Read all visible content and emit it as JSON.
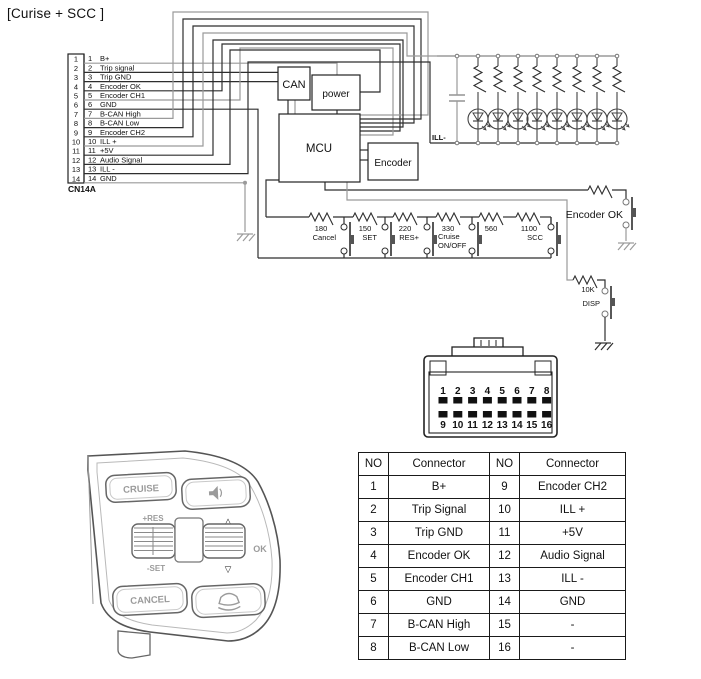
{
  "title": "[Curise + SCC ]",
  "connector_block": {
    "label": "CN14A",
    "pins": [
      {
        "no": "1",
        "label": "B+"
      },
      {
        "no": "2",
        "label": "Trip signal"
      },
      {
        "no": "3",
        "label": "Trip GND"
      },
      {
        "no": "4",
        "label": "Encoder OK"
      },
      {
        "no": "5",
        "label": "Encoder CH1"
      },
      {
        "no": "6",
        "label": "GND"
      },
      {
        "no": "7",
        "label": "B-CAN High"
      },
      {
        "no": "8",
        "label": "B-CAN Low"
      },
      {
        "no": "9",
        "label": "Encoder CH2"
      },
      {
        "no": "10",
        "label": "ILL +"
      },
      {
        "no": "11",
        "label": "+5V"
      },
      {
        "no": "12",
        "label": "Audio Signal"
      },
      {
        "no": "13",
        "label": "ILL -"
      },
      {
        "no": "14",
        "label": "GND"
      }
    ]
  },
  "blocks": {
    "can": "CAN",
    "power": "power",
    "mcu": "MCU",
    "encoder": "Encoder"
  },
  "led_section": {
    "ill_minus": "ILL-",
    "led_count": 8
  },
  "ladder": {
    "resistors": [
      "180",
      "150",
      "220",
      "330",
      "560",
      "1100"
    ],
    "buttons": [
      "Cancel",
      "SET",
      "RES+",
      "Cruise ON/OFF",
      "SCC"
    ]
  },
  "right_branch": {
    "encoder_ok": "Encoder OK",
    "r10k": "10K",
    "disp": "DISP"
  },
  "pin_connector": {
    "top_row": [
      "1",
      "2",
      "3",
      "4",
      "5",
      "6",
      "7",
      "8"
    ],
    "bottom_row": [
      "9",
      "10",
      "11",
      "12",
      "13",
      "14",
      "15",
      "16"
    ]
  },
  "table": {
    "headers": [
      "NO",
      "Connector",
      "NO",
      "Connector"
    ],
    "rows": [
      [
        "1",
        "B+",
        "9",
        "Encoder CH2"
      ],
      [
        "2",
        "Trip Signal",
        "10",
        "ILL +"
      ],
      [
        "3",
        "Trip GND",
        "11",
        "+5V"
      ],
      [
        "4",
        "Encoder OK",
        "12",
        "Audio Signal"
      ],
      [
        "5",
        "Encoder CH1",
        "13",
        "ILL -"
      ],
      [
        "6",
        "GND",
        "14",
        "GND"
      ],
      [
        "7",
        "B-CAN High",
        "15",
        "-"
      ],
      [
        "8",
        "B-CAN Low",
        "16",
        "-"
      ]
    ]
  },
  "steering": {
    "cruise": "CRUISE",
    "res": "+RES",
    "set": "-SET",
    "ok": "OK",
    "cancel": "CANCEL",
    "up": "△",
    "down": "▽"
  },
  "icons": {
    "steering_audio": "speaker-icon",
    "steering_scc": "vehicle-distance-icon"
  },
  "colors": {
    "wire_dark": "#2e2e2e",
    "wire_gray": "#9a9a9a",
    "label_gray": "#9b9b9b"
  }
}
